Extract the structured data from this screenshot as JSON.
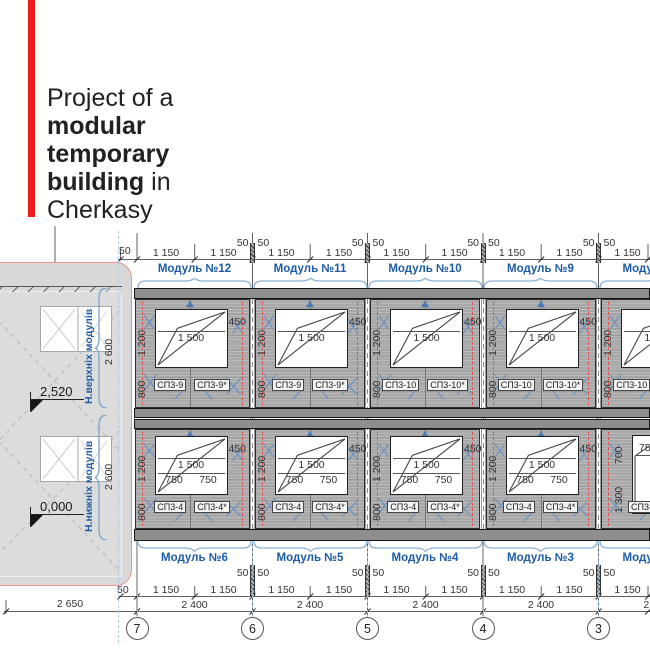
{
  "title": {
    "line1": "Project of a",
    "line2": "modular",
    "line3": "temporary",
    "line4_bold": "building",
    "line4_rest": " in",
    "line5": "Cherkasy"
  },
  "side_view": {
    "upper_modules_label": "Н.верхніх модулів",
    "lower_modules_label": "Н.нижніх модулів",
    "upper_height": "2 600",
    "lower_height": "2 600",
    "upper_elevation": "2,520",
    "lower_elevation": "0,000",
    "width": "2 650",
    "edge_offset": "50"
  },
  "elevation": {
    "dims": {
      "d50": "50",
      "d1150": "1 150",
      "d2400": "2 400",
      "d1500": "1 500",
      "d450": "450",
      "d1200": "1 200",
      "d800": "800",
      "d750": "750",
      "d700": "700",
      "d1300": "1 300"
    },
    "top_modules": [
      {
        "label": "Модуль №12",
        "panel_left": "СП3-9",
        "panel_right": "СП3-9*"
      },
      {
        "label": "Модуль №11",
        "panel_left": "СП3-9",
        "panel_right": "СП3-9*"
      },
      {
        "label": "Модуль №10",
        "panel_left": "СП3-10",
        "panel_right": "СП3-10*"
      },
      {
        "label": "Модуль №9",
        "panel_left": "СП3-10",
        "panel_right": "СП3-10*"
      },
      {
        "label": "Модуль №8",
        "panel_left": "СП3-10",
        "panel_right": "СП3-10*"
      }
    ],
    "bottom_modules": [
      {
        "label": "Модуль №6",
        "panel_left": "СП3-4",
        "panel_right": "СП3-4*"
      },
      {
        "label": "Модуль №5",
        "panel_left": "СП3-4",
        "panel_right": "СП3-4*"
      },
      {
        "label": "Модуль №4",
        "panel_left": "СП3-4",
        "panel_right": "СП3-4*"
      },
      {
        "label": "Модуль №3",
        "panel_left": "СП3-4",
        "panel_right": "СП3-4*"
      },
      {
        "label": "Модуль №2",
        "panel_left": "СП3-3"
      }
    ],
    "grid_bubbles": [
      "7",
      "6",
      "5",
      "4",
      "3"
    ]
  },
  "colors": {
    "accent_red": "#ed1c1c",
    "module_label_blue": "#1d5ba6",
    "panel_gray": "#a9a9a9",
    "band_gray": "#8e8e8e"
  }
}
